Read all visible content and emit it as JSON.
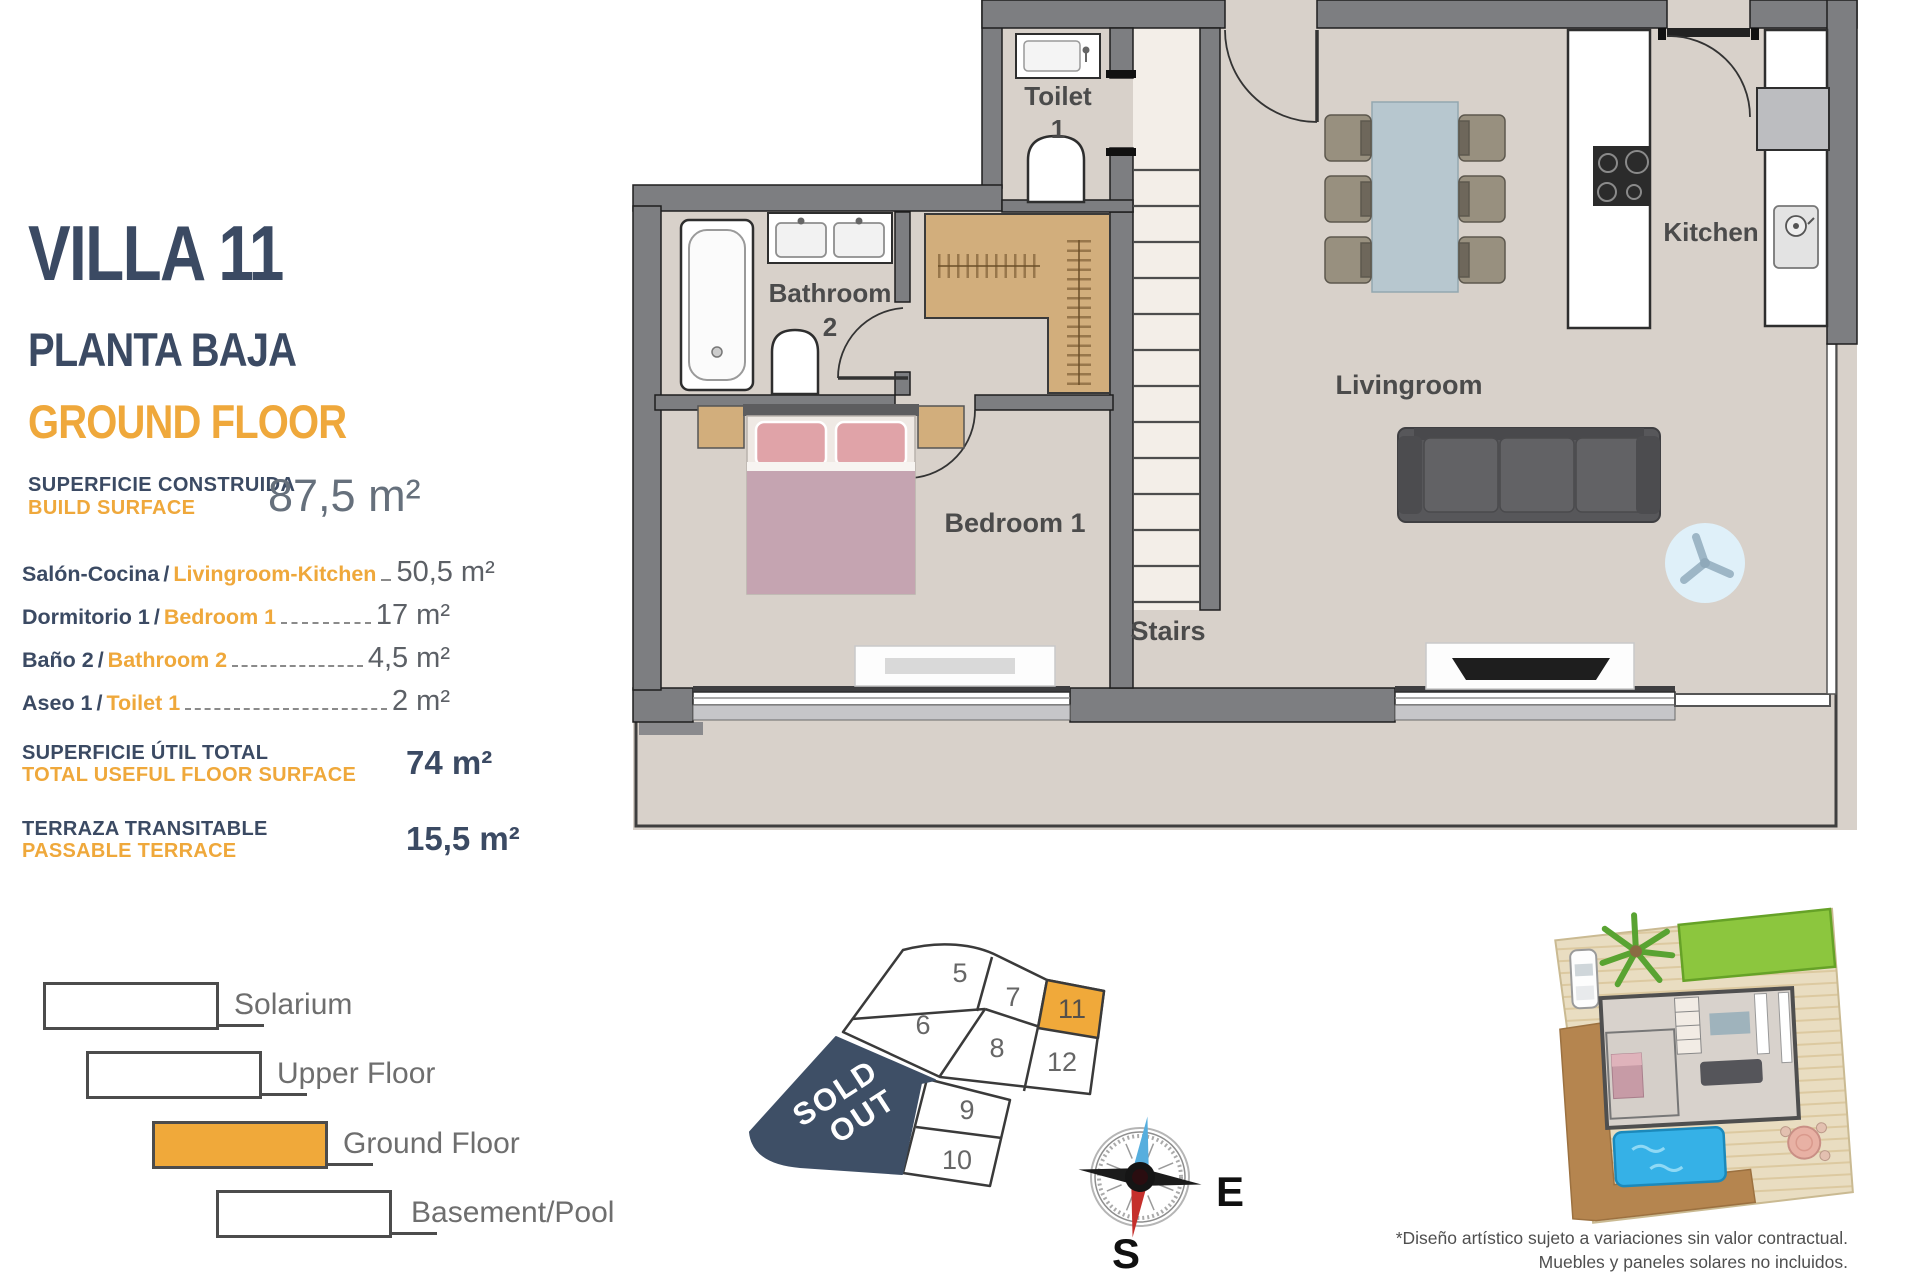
{
  "panel": {
    "title": "VILLA 11",
    "subtitle_es": "PLANTA BAJA",
    "subtitle_en": "GROUND FLOOR",
    "build_surface": {
      "label_es": "SUPERFICIE CONSTRUIDA",
      "label_en": "BUILD SURFACE",
      "value": "87,5 m²"
    },
    "rooms": [
      {
        "label_es": "Salón-Cocina",
        "label_en": "Livingroom-Kitchen",
        "value": "50,5 m²"
      },
      {
        "label_es": "Dormitorio 1",
        "label_en": "Bedroom 1",
        "value": "17 m²"
      },
      {
        "label_es": "Baño 2",
        "label_en": "Bathroom 2",
        "value": "4,5 m²"
      },
      {
        "label_es": "Aseo 1",
        "label_en": "Toilet 1",
        "value": "2 m²"
      }
    ],
    "totals": [
      {
        "label_es": "SUPERFICIE ÚTIL TOTAL",
        "label_en": "TOTAL USEFUL FLOOR SURFACE",
        "value": "74 m²"
      },
      {
        "label_es": "TERRAZA TRANSITABLE",
        "label_en": "PASSABLE TERRACE",
        "value": "15,5 m²"
      }
    ]
  },
  "plan": {
    "labels": {
      "toilet_l1": "Toilet",
      "toilet_l2": "1",
      "bathroom_l1": "Bathroom",
      "bathroom_l2": "2",
      "bedroom": "Bedroom 1",
      "stairs": "Stairs",
      "livingroom": "Livingroom",
      "kitchen": "Kitchen"
    }
  },
  "legend": {
    "items": [
      {
        "label": "Solarium",
        "active": false
      },
      {
        "label": "Upper Floor",
        "active": false
      },
      {
        "label": "Ground Floor",
        "active": true
      },
      {
        "label": "Basement/Pool",
        "active": false
      }
    ]
  },
  "plot_map": {
    "cells": [
      {
        "label": "5"
      },
      {
        "label": "7"
      },
      {
        "label": "11"
      },
      {
        "label": "6"
      },
      {
        "label": "8"
      },
      {
        "label": "12"
      },
      {
        "label": "9"
      },
      {
        "label": "10"
      }
    ],
    "highlighted_cell": "11",
    "sold_out_line1": "SOLD",
    "sold_out_line2": "OUT"
  },
  "compass": {
    "east": "E",
    "south": "S"
  },
  "disclaimer": {
    "line1": "*Diseño artístico sujeto a variaciones sin valor contractual.",
    "line2": "Muebles y paneles solares no incluidos."
  },
  "colors": {
    "navy": "#3b4a63",
    "orange": "#efa83b",
    "sold_out_navy": "#3e4f66",
    "highlight": "#f0a93a"
  }
}
